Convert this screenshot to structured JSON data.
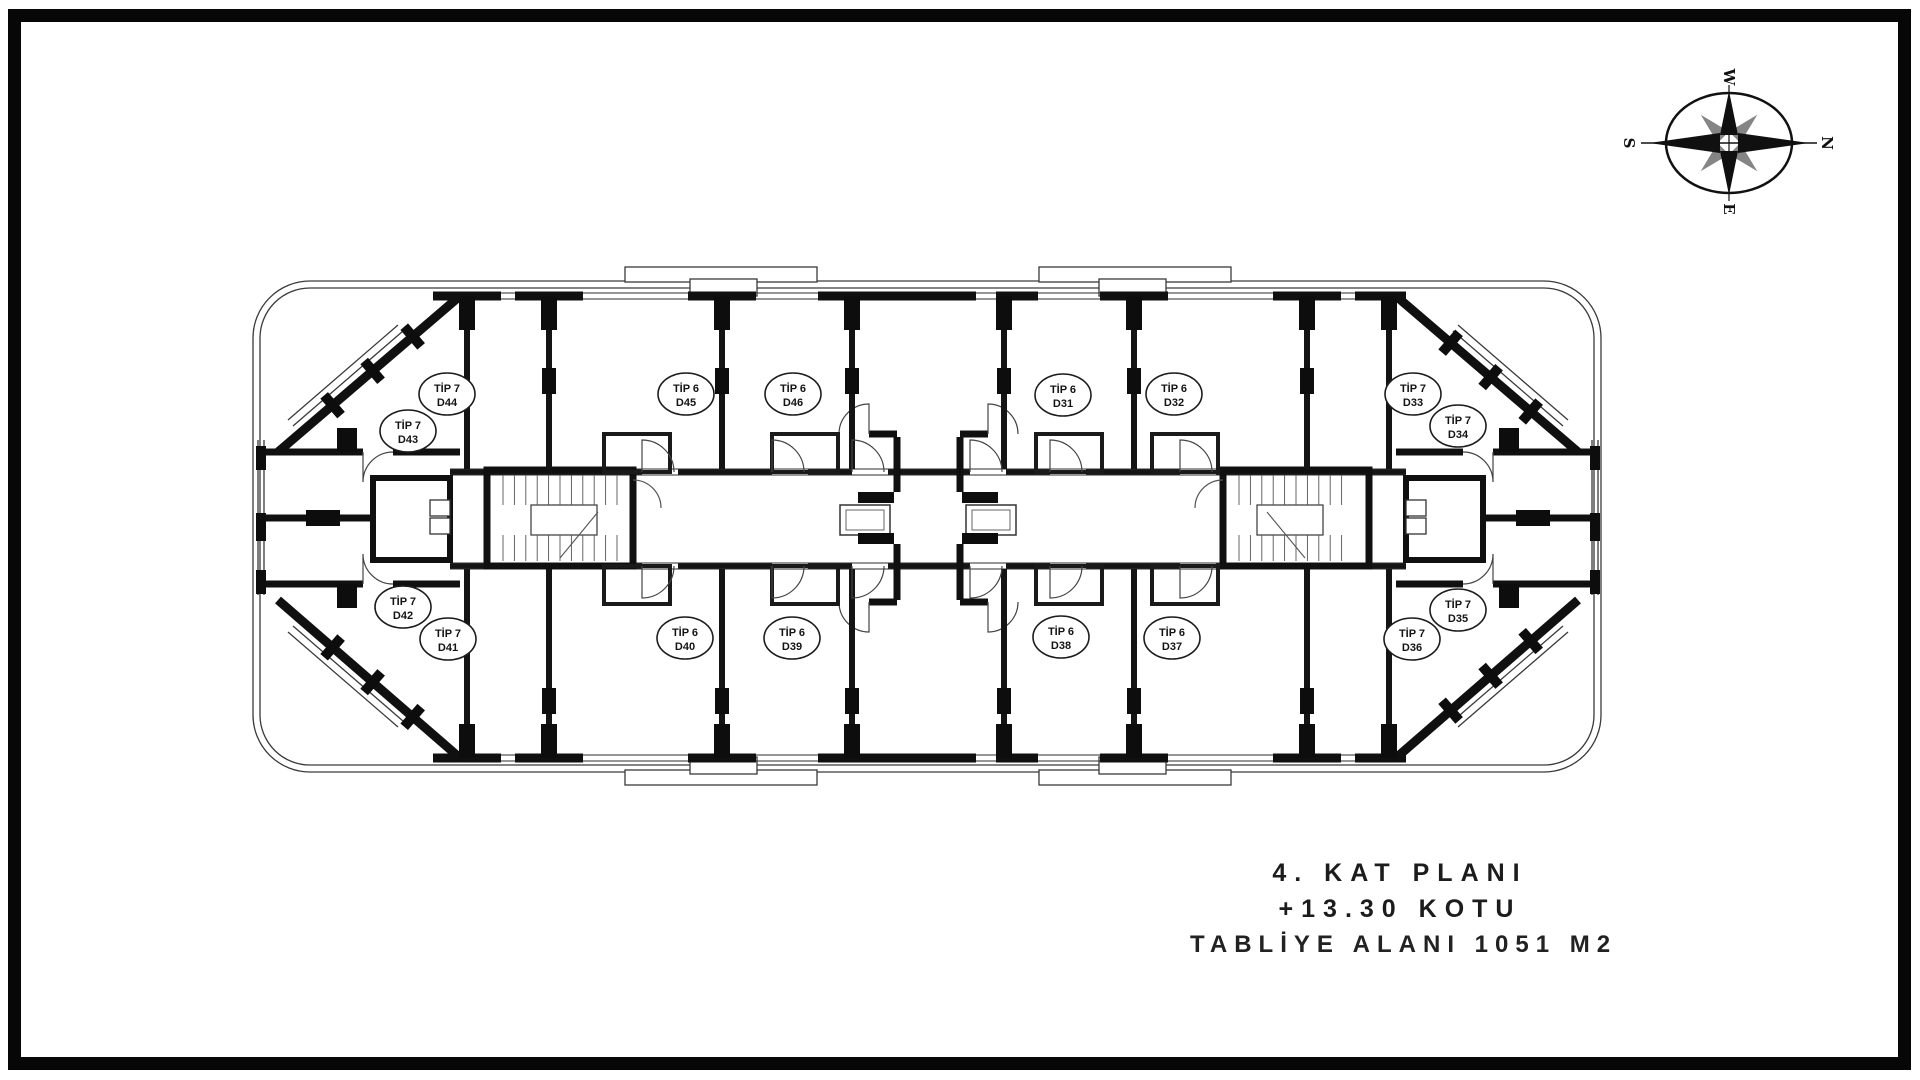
{
  "drawing": {
    "title_lines": [
      "4. KAT PLANI",
      "+13.30 KOTU",
      "TABLİYE ALANI 1051 M2"
    ]
  },
  "compass": {
    "letters": {
      "north": "N",
      "south": "S",
      "east": "E",
      "west": "W"
    }
  },
  "plan": {
    "units": [
      {
        "tip": "TİP 7",
        "no": "D44",
        "x": 447,
        "y": 394
      },
      {
        "tip": "TİP 7",
        "no": "D43",
        "x": 408,
        "y": 431
      },
      {
        "tip": "TİP 6",
        "no": "D45",
        "x": 686,
        "y": 394
      },
      {
        "tip": "TİP 6",
        "no": "D46",
        "x": 793,
        "y": 394
      },
      {
        "tip": "TİP 6",
        "no": "D31",
        "x": 1063,
        "y": 395
      },
      {
        "tip": "TİP 6",
        "no": "D32",
        "x": 1174,
        "y": 394
      },
      {
        "tip": "TİP 7",
        "no": "D33",
        "x": 1413,
        "y": 394
      },
      {
        "tip": "TİP 7",
        "no": "D34",
        "x": 1458,
        "y": 426
      },
      {
        "tip": "TİP 7",
        "no": "D42",
        "x": 403,
        "y": 607
      },
      {
        "tip": "TİP 7",
        "no": "D41",
        "x": 448,
        "y": 639
      },
      {
        "tip": "TİP 6",
        "no": "D40",
        "x": 685,
        "y": 638
      },
      {
        "tip": "TİP 6",
        "no": "D39",
        "x": 792,
        "y": 638
      },
      {
        "tip": "TİP 6",
        "no": "D38",
        "x": 1061,
        "y": 637
      },
      {
        "tip": "TİP 6",
        "no": "D37",
        "x": 1172,
        "y": 638
      },
      {
        "tip": "TİP 7",
        "no": "D36",
        "x": 1412,
        "y": 639
      },
      {
        "tip": "TİP 7",
        "no": "D35",
        "x": 1458,
        "y": 610
      }
    ]
  },
  "colors": {
    "line": "#1a1a1a",
    "secondary_point": "#858585"
  }
}
